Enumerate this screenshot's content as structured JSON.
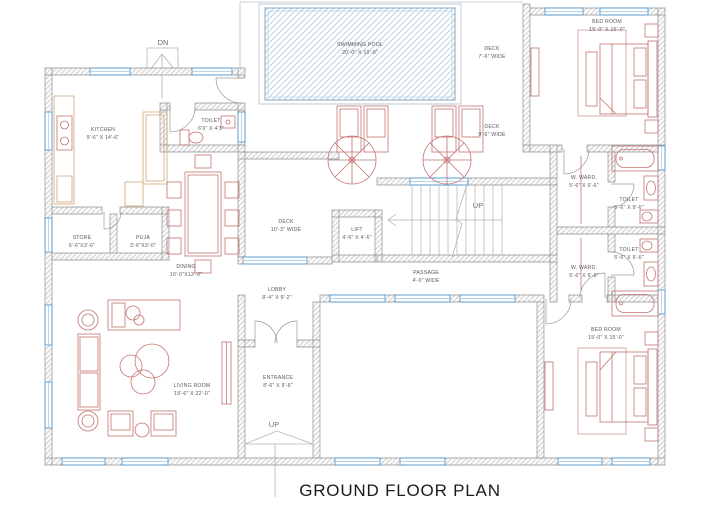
{
  "title": "GROUND FLOOR PLAN",
  "markers": {
    "dn": "DN",
    "up_stairs": "UP",
    "up_entrance": "UP"
  },
  "rooms": {
    "swimming_pool": {
      "name": "SWIMMING POOL",
      "dims": "20'-0\" X 10'-0\""
    },
    "deck_top": {
      "name": "DECK",
      "dims": "7'-6\" WIDE"
    },
    "deck_mid": {
      "name": "DECK",
      "dims": "9'-6\" WIDE"
    },
    "deck_left": {
      "name": "DECK",
      "dims": "10'-3\" WIDE"
    },
    "bedroom_top": {
      "name": "BED ROOM",
      "dims": "15'-0\" X 15'-0\""
    },
    "kitchen": {
      "name": "KITCHEN",
      "dims": "9'-6\" X 14'-6\""
    },
    "toilet_kitchen": {
      "name": "TOILET",
      "dims": "6'6\" X 4'3\""
    },
    "store": {
      "name": "STORE",
      "dims": "6'-6\"X3'-6\""
    },
    "puja": {
      "name": "PUJA",
      "dims": "3'-6\"X3'-0\""
    },
    "dining": {
      "name": "DINING",
      "dims": "10'-0\"X13'-0\""
    },
    "lift": {
      "name": "LIFT",
      "dims": "4'-6\" X 4'-6\""
    },
    "passage": {
      "name": "PASSAGE",
      "dims": "4'-0\" WIDE"
    },
    "w_ward_top": {
      "name": "W. WARD.",
      "dims": "5'-6\" X 9'-6\""
    },
    "toilet_top": {
      "name": "TOILET",
      "dims": "5'-6\" X 9'-6\""
    },
    "toilet_bottom": {
      "name": "TOILET",
      "dims": "5'-6\" X 9'-6\""
    },
    "w_ward_bottom": {
      "name": "W. WARD.",
      "dims": "5'-6\" X 9'-6\""
    },
    "lobby": {
      "name": "LOBBY",
      "dims": "8'-4\" X 9'-2\""
    },
    "entrance": {
      "name": "ENTRANCE",
      "dims": "8'-6\" X 9'-6\""
    },
    "living_room": {
      "name": "LIVING ROOM",
      "dims": "19'-6\" X 22'-0\""
    },
    "bedroom_bottom": {
      "name": "BED ROOM",
      "dims": "15'-0\" X 15'-0\""
    }
  },
  "colors": {
    "wall_hatch": "#c9c9c9",
    "wall_edge": "#909090",
    "window_blue": "#4f97d0",
    "pool_hatch_blue": "#b9d5e8",
    "furniture_red": "#c4736e",
    "cabinet_tan": "#d2a679",
    "label_text": "#5a5a5a",
    "title_text": "#1b1b1b"
  }
}
